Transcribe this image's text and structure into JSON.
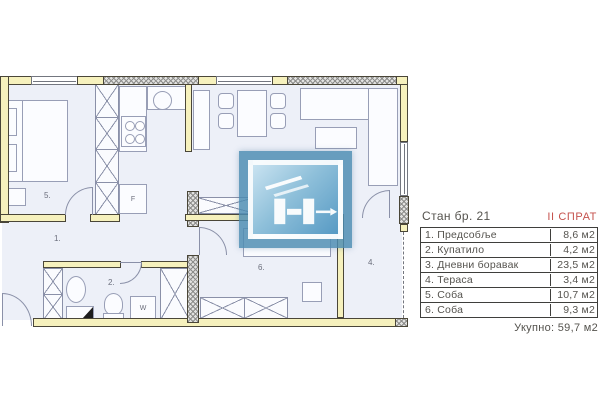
{
  "legend": {
    "title": "Стан бр. 21",
    "floor": "II СПРАТ",
    "rows": [
      {
        "label": "1. Предсобље",
        "area": "8,6 м2"
      },
      {
        "label": "2. Купатило",
        "area": "4,2 м2"
      },
      {
        "label": "3. Дневни боравак",
        "area": "23,5 м2"
      },
      {
        "label": "4. Тераса",
        "area": "3,4 м2"
      },
      {
        "label": "5. Соба",
        "area": "10,7 м2"
      },
      {
        "label": "6. Соба",
        "area": "9,3 м2"
      }
    ],
    "total": "Укупно: 59,7 м2"
  },
  "plan": {
    "room_labels": {
      "hallway": "1.",
      "bathroom": "2.",
      "living": "3.",
      "terrace": "4.",
      "bedroom1": "5.",
      "bedroom2": "6."
    },
    "appliance_labels": {
      "fridge": "F",
      "washer": "W"
    }
  },
  "colors": {
    "wall_yellow": "#f6f1bd",
    "accent_red": "#c5524d",
    "logo_blue": "#4c8cb2",
    "floor": "#edf0f8"
  }
}
